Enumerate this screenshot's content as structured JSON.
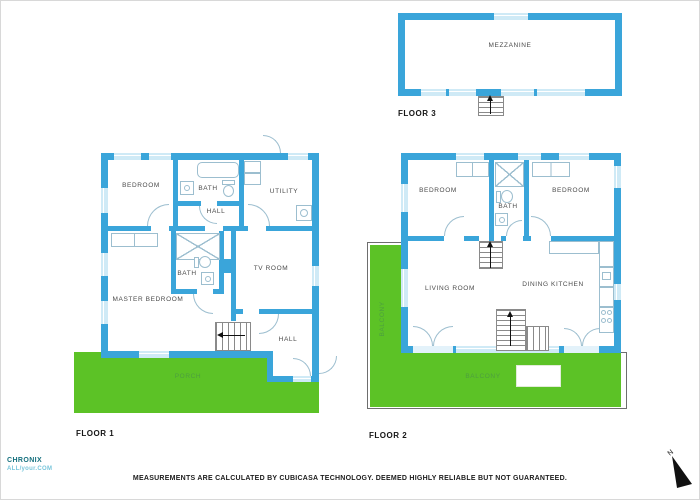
{
  "colors": {
    "wall": "#3aa5da",
    "window_fill": "#cfeaf6",
    "outdoor_green": "#5cc226",
    "outdoor_label": "#4d9f3f",
    "room_label": "#4b4b4b",
    "floor_label": "#161616",
    "fixture_line": "#9cbecf",
    "balcony_border": "#6e6e6e",
    "stair_line": "#8a8a8a",
    "logo_teal": "#15707e",
    "logo_light": "#79c6db",
    "compass_black": "#111111"
  },
  "floors": {
    "f1": {
      "label": "FLOOR 1",
      "rooms": {
        "bedroom": "BEDROOM",
        "bath_top": "BATH",
        "utility": "UTILITY",
        "hall_upper": "HALL",
        "bath_mid": "BATH",
        "tv_room": "TV ROOM",
        "master_bedroom": "MASTER BEDROOM",
        "hall_lower": "HALL",
        "porch": "PORCH"
      }
    },
    "f2": {
      "label": "FLOOR 2",
      "rooms": {
        "bedroom_left": "BEDROOM",
        "bath": "BATH",
        "bedroom_right": "BEDROOM",
        "living_room": "LIVING ROOM",
        "dining_kitchen": "DINING KITCHEN",
        "balcony_left": "BALCONY",
        "balcony_bottom": "BALCONY"
      }
    },
    "f3": {
      "label": "FLOOR 3",
      "rooms": {
        "mezzanine": "MEZZANINE"
      }
    }
  },
  "branding": {
    "logo_line1": "CHRONIX",
    "logo_line2": "ALL/your.COM"
  },
  "compass": {
    "north_label": "N"
  },
  "footer": {
    "disclaimer": "MEASUREMENTS ARE CALCULATED BY CUBICASA TECHNOLOGY. DEEMED HIGHLY RELIABLE BUT NOT GUARANTEED."
  }
}
